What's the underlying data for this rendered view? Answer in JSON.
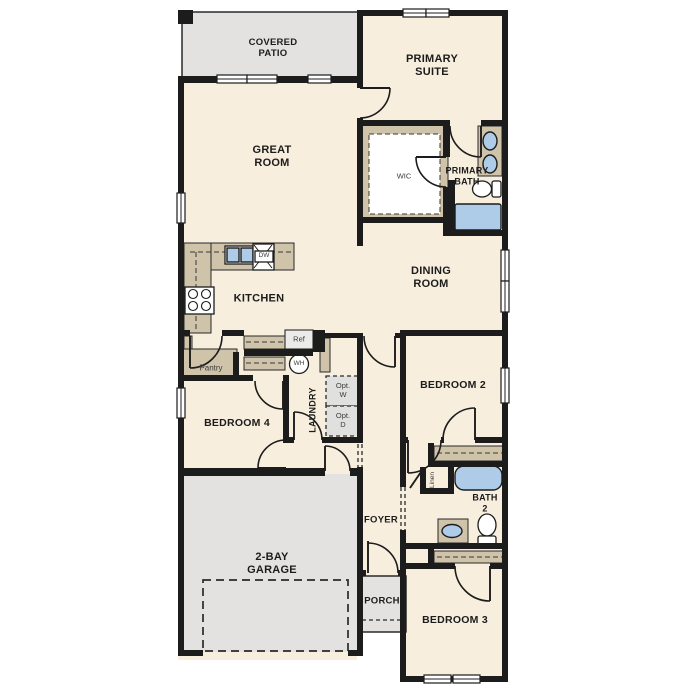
{
  "colors": {
    "room_fill": "#f7eede",
    "outdoor_fill": "#e3e2e0",
    "cabinet_tan": "#cfc3aa",
    "fixture_blue": "#aecbe8",
    "wall_color": "#1c1c1c"
  },
  "labels": {
    "covered_patio": "COVERED\nPATIO",
    "primary_suite": "PRIMARY\nSUITE",
    "great_room": "GREAT\nROOM",
    "wic": "WIC",
    "primary_bath": "PRIMARY\nBATH",
    "dining_room": "DINING\nROOM",
    "kitchen": "KITCHEN",
    "pantry": "Pantry",
    "ref": "Ref",
    "dw": "DW",
    "wh": "WH",
    "laundry": "LAUNDRY",
    "opt_washer": "Opt.\nW",
    "opt_dryer": "Opt.\nD",
    "bedroom_2": "BEDROOM 2",
    "bedroom_4": "BEDROOM 4",
    "foyer": "FOYER",
    "porch": "PORCH",
    "garage": "2-BAY\nGARAGE",
    "bath_2": "BATH\n2",
    "linen": "Linen",
    "bedroom_3": "BEDROOM 3"
  },
  "fixtures": {
    "kitchen": [
      "sink-icon",
      "dishwasher-icon",
      "range-icon",
      "refrigerator-icon"
    ],
    "utility": [
      "water-heater-icon",
      "optional-washer-box",
      "optional-dryer-box"
    ],
    "primary_bath": [
      "double-sink-vanity-icon",
      "toilet-icon",
      "tub-icon"
    ],
    "bath_2": [
      "tub-icon",
      "sink-vanity-icon",
      "toilet-icon"
    ],
    "other": [
      "garage-door-dashed-outline",
      "closet-shelf-dashed",
      "cased-opening-dashed"
    ]
  }
}
